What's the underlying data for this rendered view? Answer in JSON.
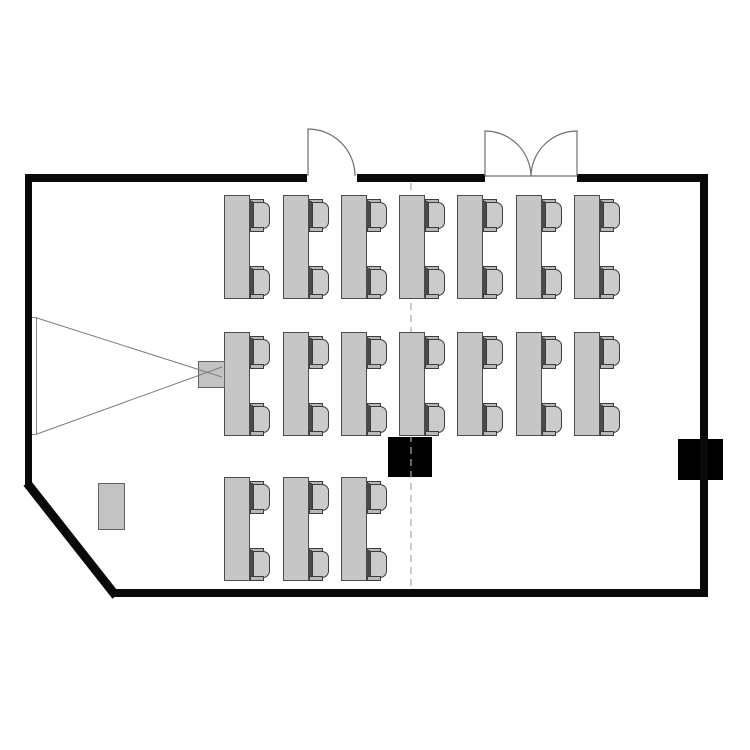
{
  "floor_plan": {
    "type": "classroom-floor-plan",
    "canvas": {
      "width": 750,
      "height": 750,
      "background": "#ffffff"
    },
    "colors": {
      "wall": "#0a0a0a",
      "door_line": "#6e6e6e",
      "beam_line": "#7d7d7d",
      "divider_line": "#ababab",
      "furniture_fill": "#c6c6c6",
      "furniture_border": "#4d4d4d",
      "equipment_black": "#000000",
      "screen_fill": "#fdfdfd"
    },
    "walls": {
      "path": "M25,174H307V182H25Z M357,174H485V182H357Z M577,174H708V182H577Z M700,182H708V597H700Z M112,589H708V597H112Z M25,182H32V487H25Z",
      "angled": {
        "x1": 27,
        "y1": 483,
        "x2": 116,
        "y2": 596,
        "width": 9
      }
    },
    "doors": [
      {
        "name": "single-door-top-left",
        "path": "M308,176 L308,129 A47,47 0 0 1 355,176"
      },
      {
        "name": "double-door-top-right",
        "path": "M485,176 L485,131 A46,46 0 0 1 531,176 M577,176 L577,131 A46,46 0 0 0 531,176 M485,176 L577,176"
      }
    ],
    "divider": {
      "x": 411,
      "y1": 183,
      "y2": 589,
      "dash": "7 5"
    },
    "projection": {
      "screen": {
        "x": 31,
        "y": 317,
        "w": 6,
        "h": 118
      },
      "projector": {
        "x": 198,
        "y": 361,
        "w": 27,
        "h": 27
      },
      "beam_lines": [
        {
          "x1": 37,
          "y1": 318,
          "x2": 222,
          "y2": 377
        },
        {
          "x1": 37,
          "y1": 434,
          "x2": 222,
          "y2": 367
        }
      ]
    },
    "furniture": {
      "desk": {
        "w": 26,
        "h": 104
      },
      "chair": {
        "w": 22,
        "h": 33,
        "offsets_y": [
          4,
          71
        ]
      },
      "columns_x": [
        224,
        283,
        341,
        399,
        457,
        516,
        574
      ],
      "rows": [
        {
          "y": 195,
          "desk_count": 7
        },
        {
          "y": 332,
          "desk_count": 7
        },
        {
          "y": 477,
          "desk_count": 3
        }
      ],
      "desk_total": 17,
      "seat_total": 34
    },
    "equipment": [
      {
        "name": "storage-cabinet",
        "type": "cabinet",
        "x": 98,
        "y": 483,
        "w": 27,
        "h": 47
      },
      {
        "name": "floor-box-center",
        "type": "black-box",
        "x": 388,
        "y": 437,
        "w": 44,
        "h": 40
      },
      {
        "name": "wall-box-right",
        "type": "black-box",
        "x": 678,
        "y": 439,
        "w": 45,
        "h": 41
      }
    ]
  }
}
